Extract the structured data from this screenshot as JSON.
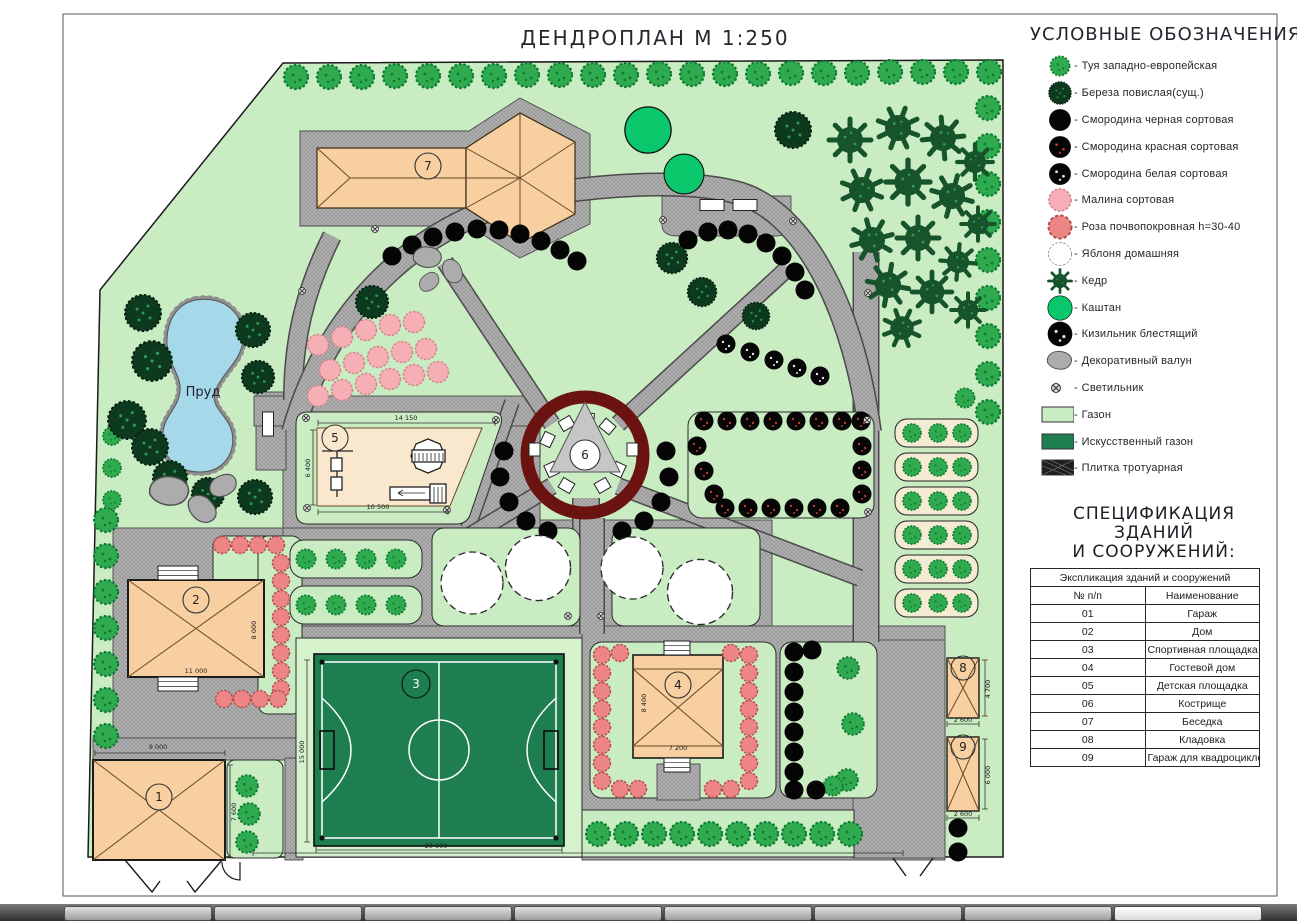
{
  "title": "ДЕНДРОПЛАН М 1:250",
  "legend": {
    "title": "УСЛОВНЫЕ ОБОЗНАЧЕНИЯ:",
    "dash": "-",
    "items": [
      {
        "symbol": "thuja-icon",
        "label": "Туя западно-европейская",
        "color": "#2faa4e"
      },
      {
        "symbol": "birch-icon",
        "label": "Береза повислая(сущ.)",
        "color": "#0d3a1e"
      },
      {
        "symbol": "blackcurrant-icon",
        "label": "Смородина черная сортовая",
        "color": "#050505"
      },
      {
        "symbol": "redcurrant-icon",
        "label": "Смородина красная сортовая",
        "color": "#050505"
      },
      {
        "symbol": "whitecurrant-icon",
        "label": "Смородина белая сортовая",
        "color": "#050505"
      },
      {
        "symbol": "raspberry-icon",
        "label": "Малина сортовая",
        "color": "#f5afb5"
      },
      {
        "symbol": "rose-icon",
        "label": "Роза почвопокровная h=30-40",
        "color": "#ee8585"
      },
      {
        "symbol": "apple-icon",
        "label": "Яблоня домашняя",
        "color": "#ffffff"
      },
      {
        "symbol": "cedar-icon",
        "label": "Кедр",
        "color": "#17532b"
      },
      {
        "symbol": "chestnut-icon",
        "label": "Каштан",
        "color": "#0bc76b"
      },
      {
        "symbol": "cotoneaster-icon",
        "label": "Кизильник блестящий",
        "color": "#050505"
      },
      {
        "symbol": "boulder-icon",
        "label": "Декоративный валун",
        "color": "#acacac"
      },
      {
        "symbol": "lamp-icon",
        "label": "Светильник",
        "color": "#e8e8e8"
      },
      {
        "symbol": "lawn-icon",
        "label": "Газон",
        "color": "#c9ecc3"
      },
      {
        "symbol": "artificial-lawn-icon",
        "label": "Искусственный газон",
        "color": "#1e7e50"
      },
      {
        "symbol": "paving-icon",
        "label": "Плитка тротуарная",
        "color": "#b5b5b5"
      }
    ]
  },
  "specification": {
    "title_line1": "СПЕЦИФИКАЦИЯ ЗДАНИЙ",
    "title_line2": "И СООРУЖЕНИЙ:",
    "table_header": "Экспликация зданий и сооружений",
    "col_num": "№ п/п",
    "col_name": "Наименование",
    "rows": [
      {
        "num": "01",
        "name": "Гараж"
      },
      {
        "num": "02",
        "name": "Дом"
      },
      {
        "num": "03",
        "name": "Спортивная площадка"
      },
      {
        "num": "04",
        "name": "Гостевой дом"
      },
      {
        "num": "05",
        "name": "Детская площадка"
      },
      {
        "num": "06",
        "name": "Кострище"
      },
      {
        "num": "07",
        "name": "Беседка"
      },
      {
        "num": "08",
        "name": "Кладовка"
      },
      {
        "num": "09",
        "name": "Гараж для квадроциклов"
      }
    ]
  },
  "map": {
    "pond_label": "Пруд",
    "markers": [
      "1",
      "2",
      "3",
      "4",
      "5",
      "6",
      "7",
      "8",
      "9"
    ],
    "dims": {
      "garage_width": "9 000",
      "garage_height": "7 600",
      "house_width": "11 000",
      "house_height": "8 000",
      "field_width": "20 000",
      "field_height": "15 000",
      "playground_top": "14 150",
      "playground_bottom": "10 500",
      "playground_height": "6 400",
      "guesthouse_width": "7 200",
      "guesthouse_height": "8 400",
      "storage_width": "2 600",
      "storage_height": "4 700",
      "quadgarage_width": "2 600",
      "quadgarage_height": "6 000"
    }
  }
}
